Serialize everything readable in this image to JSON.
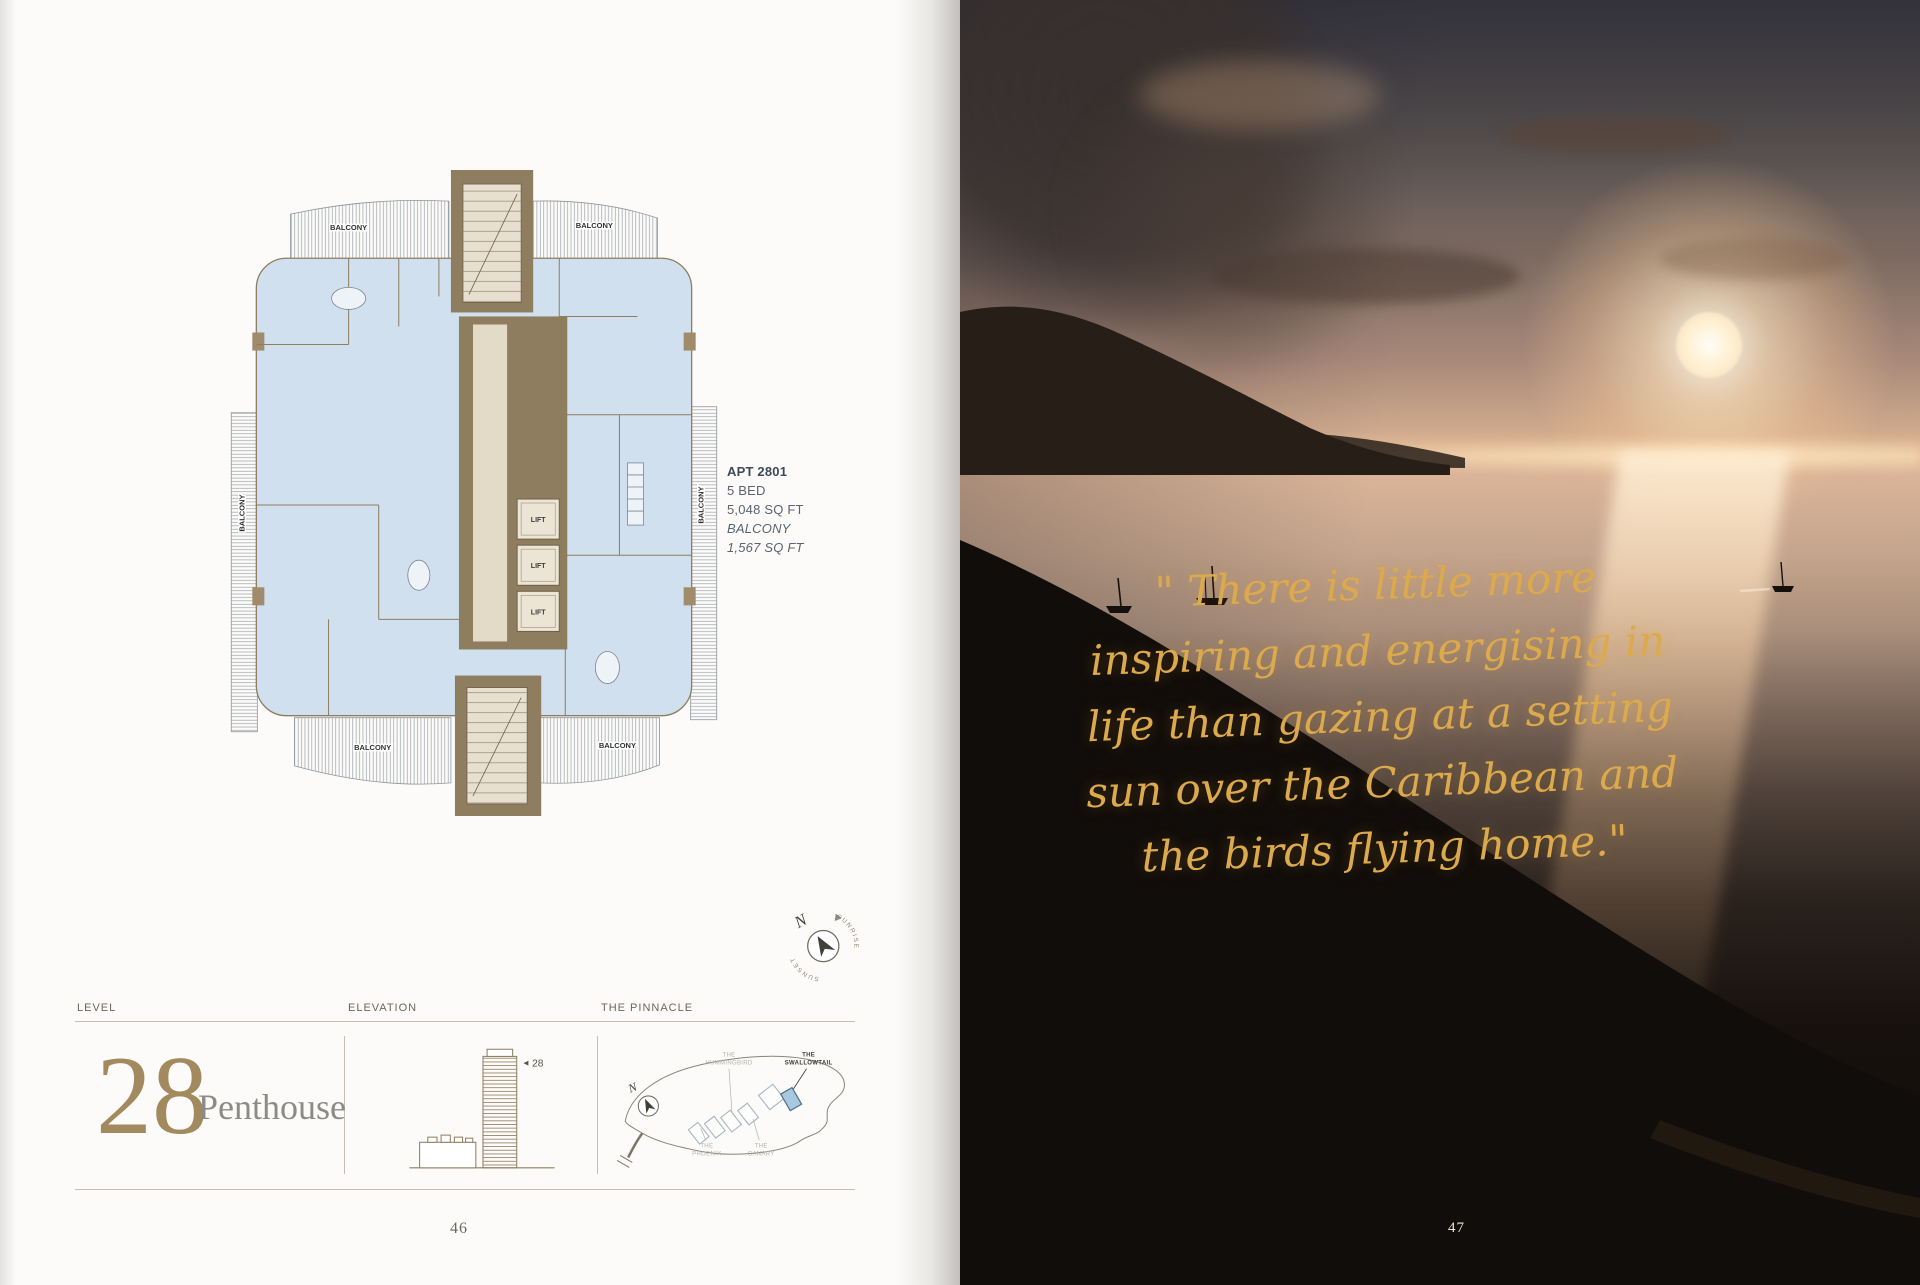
{
  "left_page": {
    "plan": {
      "balcony_label": "BALCONY",
      "lift_label": "LIFT",
      "apartment": {
        "id": "APT 2801",
        "beds": "5 BED",
        "area": "5,048 SQ FT",
        "balcony_title": "BALCONY",
        "balcony_area": "1,567 SQ FT"
      },
      "compass": {
        "north": "N",
        "sunrise": "SUNRISE",
        "sunset": "SUNSET"
      }
    },
    "info_bar": {
      "level": {
        "header": "LEVEL",
        "number": "28",
        "name": "Penthouse"
      },
      "elevation": {
        "header": "ELEVATION",
        "marker_arrow": "◄",
        "marker_level": "28"
      },
      "site": {
        "header": "THE PINNACLE",
        "north": "N",
        "buildings": [
          {
            "line1": "THE",
            "line2": "HUMMINGBIRD",
            "highlighted": false
          },
          {
            "line1": "THE",
            "line2": "SWALLOWTAIL",
            "highlighted": true
          },
          {
            "line1": "THE",
            "line2": "PHOENIX",
            "highlighted": false
          },
          {
            "line1": "THE",
            "line2": "CANARY",
            "highlighted": false
          }
        ]
      }
    },
    "page_number": "46"
  },
  "right_page": {
    "quote": {
      "lines": [
        "\" There is little more",
        "inspiring and energising in",
        "life than gazing at a setting",
        "sun over the Caribbean and",
        "the birds flying home.\""
      ]
    },
    "page_number": "47"
  },
  "colors": {
    "accent_gold": "#a28a5e",
    "quote_gold": "#dca94c",
    "plan_floor_blue": "#d0e0ee",
    "plan_core_brown": "#8f7d5f",
    "site_highlight_blue": "#a9c7dd"
  }
}
